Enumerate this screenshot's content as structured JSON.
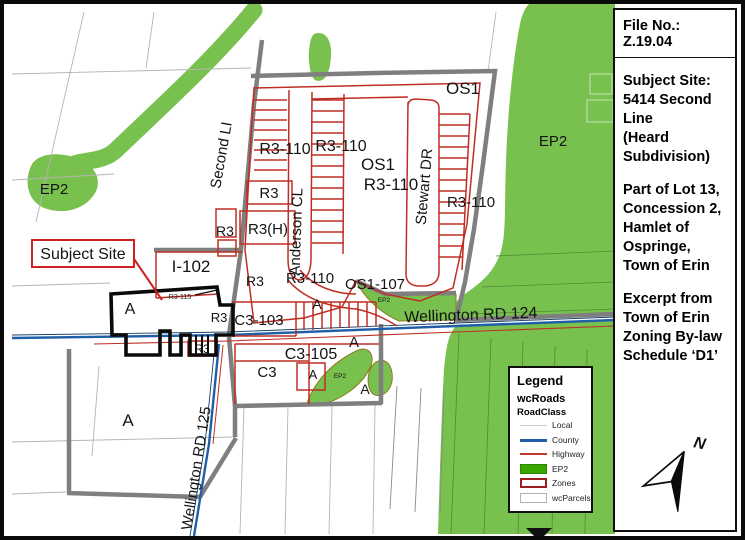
{
  "sidebar": {
    "file_no": "File No.:  Z.19.04",
    "subject_block": "Subject Site:\n5414 Second Line\n(Heard\nSubdivision)",
    "lot_block": "Part of Lot 13,\nConcession 2,\nHamlet of\nOspringe,\nTown of Erin",
    "excerpt_block": "Excerpt from\nTown of Erin\nZoning By-law\nSchedule ‘D1’",
    "north_label": "N"
  },
  "legend": {
    "title": "Legend",
    "subtitle": "wcRoads",
    "subsubtitle": "RoadClass",
    "entries": [
      {
        "label": "Local",
        "swatch": "local-line"
      },
      {
        "label": "County",
        "swatch": "county-line"
      },
      {
        "label": "Highway",
        "swatch": "highway-line"
      },
      {
        "label": "EP2",
        "swatch": "ep2-fill"
      },
      {
        "label": "Zones",
        "swatch": "zones-outline"
      },
      {
        "label": "wcParcels",
        "swatch": "parcels-outline"
      }
    ]
  },
  "map": {
    "callout": "Subject Site",
    "labels": {
      "ep2": "EP2",
      "second_line": "Second LI",
      "os1": "OS1",
      "r3_110": "R3-110",
      "r3": "R3",
      "r3_h": "R3(H)",
      "anderson_cl": "Anderson CL",
      "stewart_dr": "Stewart DR",
      "os1_107": "OS1-107",
      "i_102": "I-102",
      "c3_103": "C3-103",
      "c3_105": "C3-105",
      "c3": "C3",
      "a": "A",
      "r3_115": "R3-115",
      "wellington_rd_124": "Wellington RD 124",
      "wellington_rd_125": "Wellington RD 125"
    },
    "colors": {
      "ep2_green": "#79c14f",
      "legend_green": "#38a800",
      "zone_red": "#bf2e24",
      "county_blue": "#1f5fa8",
      "road_gray": "#7f7f7f",
      "boundary_dark_red": "#9e1f1f"
    }
  }
}
